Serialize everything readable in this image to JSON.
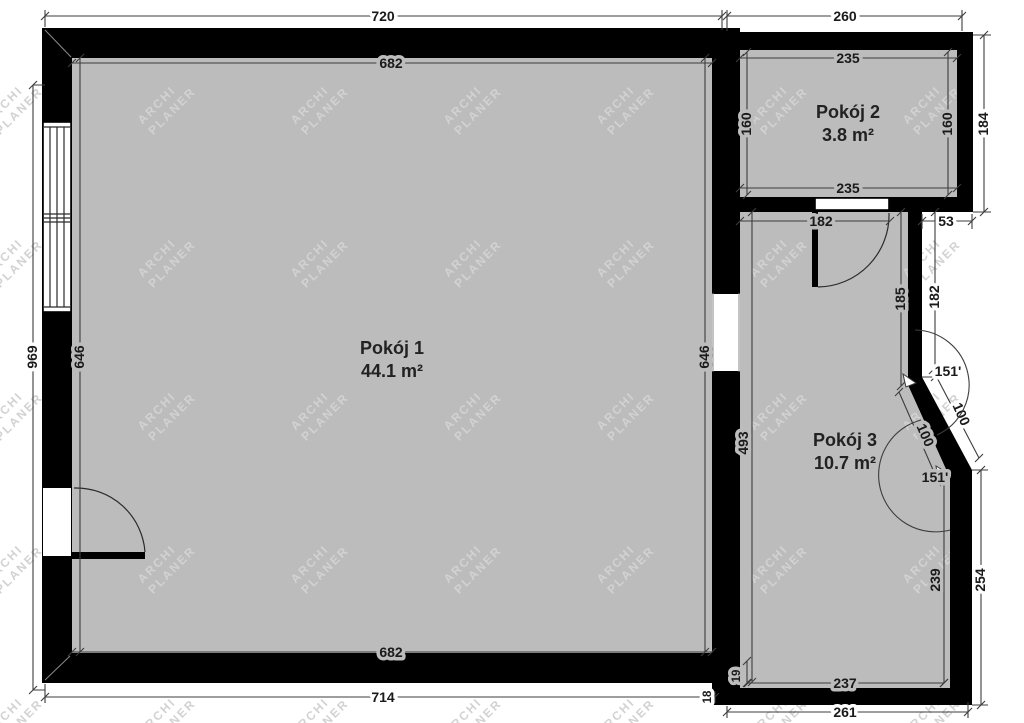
{
  "plan": {
    "watermark": {
      "line1": "ARCHI",
      "line2": "PLANER"
    },
    "rooms": [
      {
        "name": "Pokój 1",
        "area": "44.1 m²"
      },
      {
        "name": "Pokój 2",
        "area": "3.8 m²"
      },
      {
        "name": "Pokój 3",
        "area": "10.7 m²"
      }
    ],
    "dims": {
      "top_left_outer": "720",
      "top_right_outer": "260",
      "p1_top_inner": "682",
      "p1_bottom_inner": "682",
      "p1_bottom_outer": "714",
      "p1_left_inner": "646",
      "p1_right_inner": "646",
      "left_outer": "969",
      "p2_top_inner": "235",
      "p2_bottom_inner": "235",
      "p2_left_inner": "160",
      "p2_right_inner": "160",
      "p2_right_outer": "184",
      "hall_seg_left": "182",
      "hall_seg_right": "53",
      "hall_right_inner": "185",
      "hall_right_outer": "182",
      "p3_left_inner": "493",
      "p3_bottom_inner": "237",
      "p3_bottom_outer": "261",
      "p3_right_inner": "239",
      "p3_right_outer": "254",
      "bevel_inner": "100",
      "bevel_outer": "100",
      "angle_top": "151'",
      "angle_bottom": "151'",
      "step_small": "19",
      "step_offset": "18"
    },
    "colors": {
      "wall": "#000000",
      "floor": "#bcbcbc",
      "watermark": "#d2d2d2",
      "dimension_text": "#1a1a1a"
    }
  }
}
